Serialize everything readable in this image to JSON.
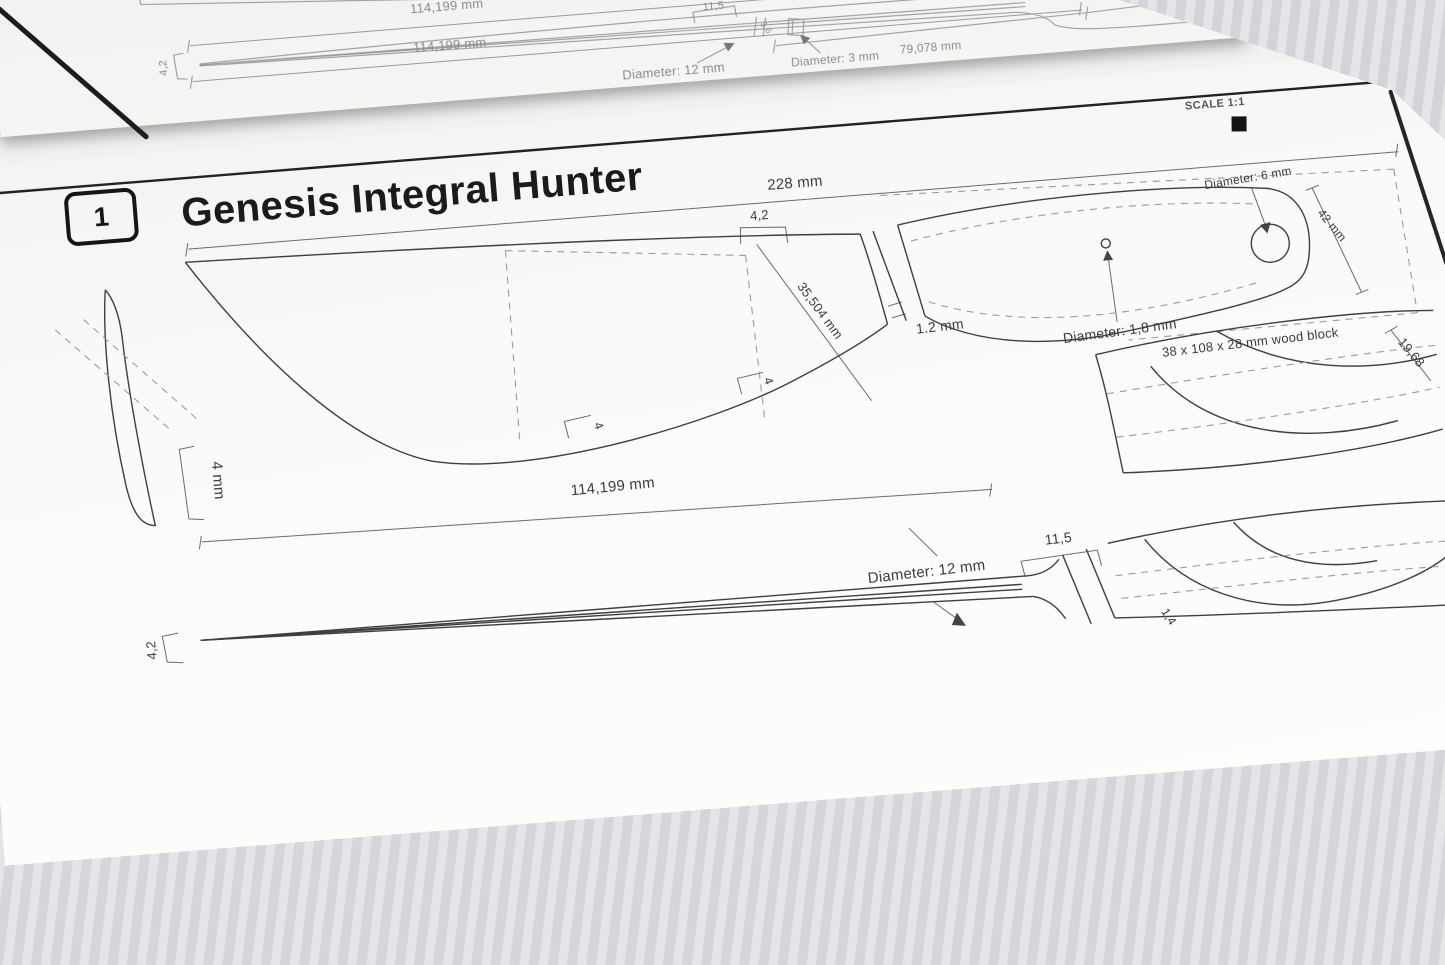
{
  "scene": {
    "upper_page": {
      "dim_length_top": "114,199 mm",
      "dim_length_blade": "114,199 mm",
      "dim_bolster": "11,5",
      "dim_neck": "3,6",
      "dim_tip": "4,2",
      "label_tang_diameter": "Diameter: 12 mm",
      "label_pin_diameter": "Diameter: 3 mm",
      "dim_tang_length": "79,078 mm"
    },
    "main_page": {
      "badge": "1",
      "title": "Genesis Integral Hunter",
      "scale": "SCALE 1:1",
      "dims": {
        "overall_length": "228 mm",
        "spine_step": "4,2",
        "blade_height": "35,504 mm",
        "edge_thickness": "1.2 mm",
        "pin_diameter": "Diameter: 1,8 mm",
        "wood_block": "38 x 108 x 28 mm wood block",
        "lanyard_diameter": "Diameter: 6 mm",
        "handle_height": "42 mm",
        "spine_thickness": "4 mm",
        "bevel_front": "4",
        "bevel_rear": "4",
        "blade_length": "114,199 mm",
        "tang_diameter": "Diameter: 12 mm",
        "bolster_width": "11,5",
        "tip_height": "4,2",
        "handle_width": "19,68",
        "scale_gap": "1,4"
      }
    }
  }
}
